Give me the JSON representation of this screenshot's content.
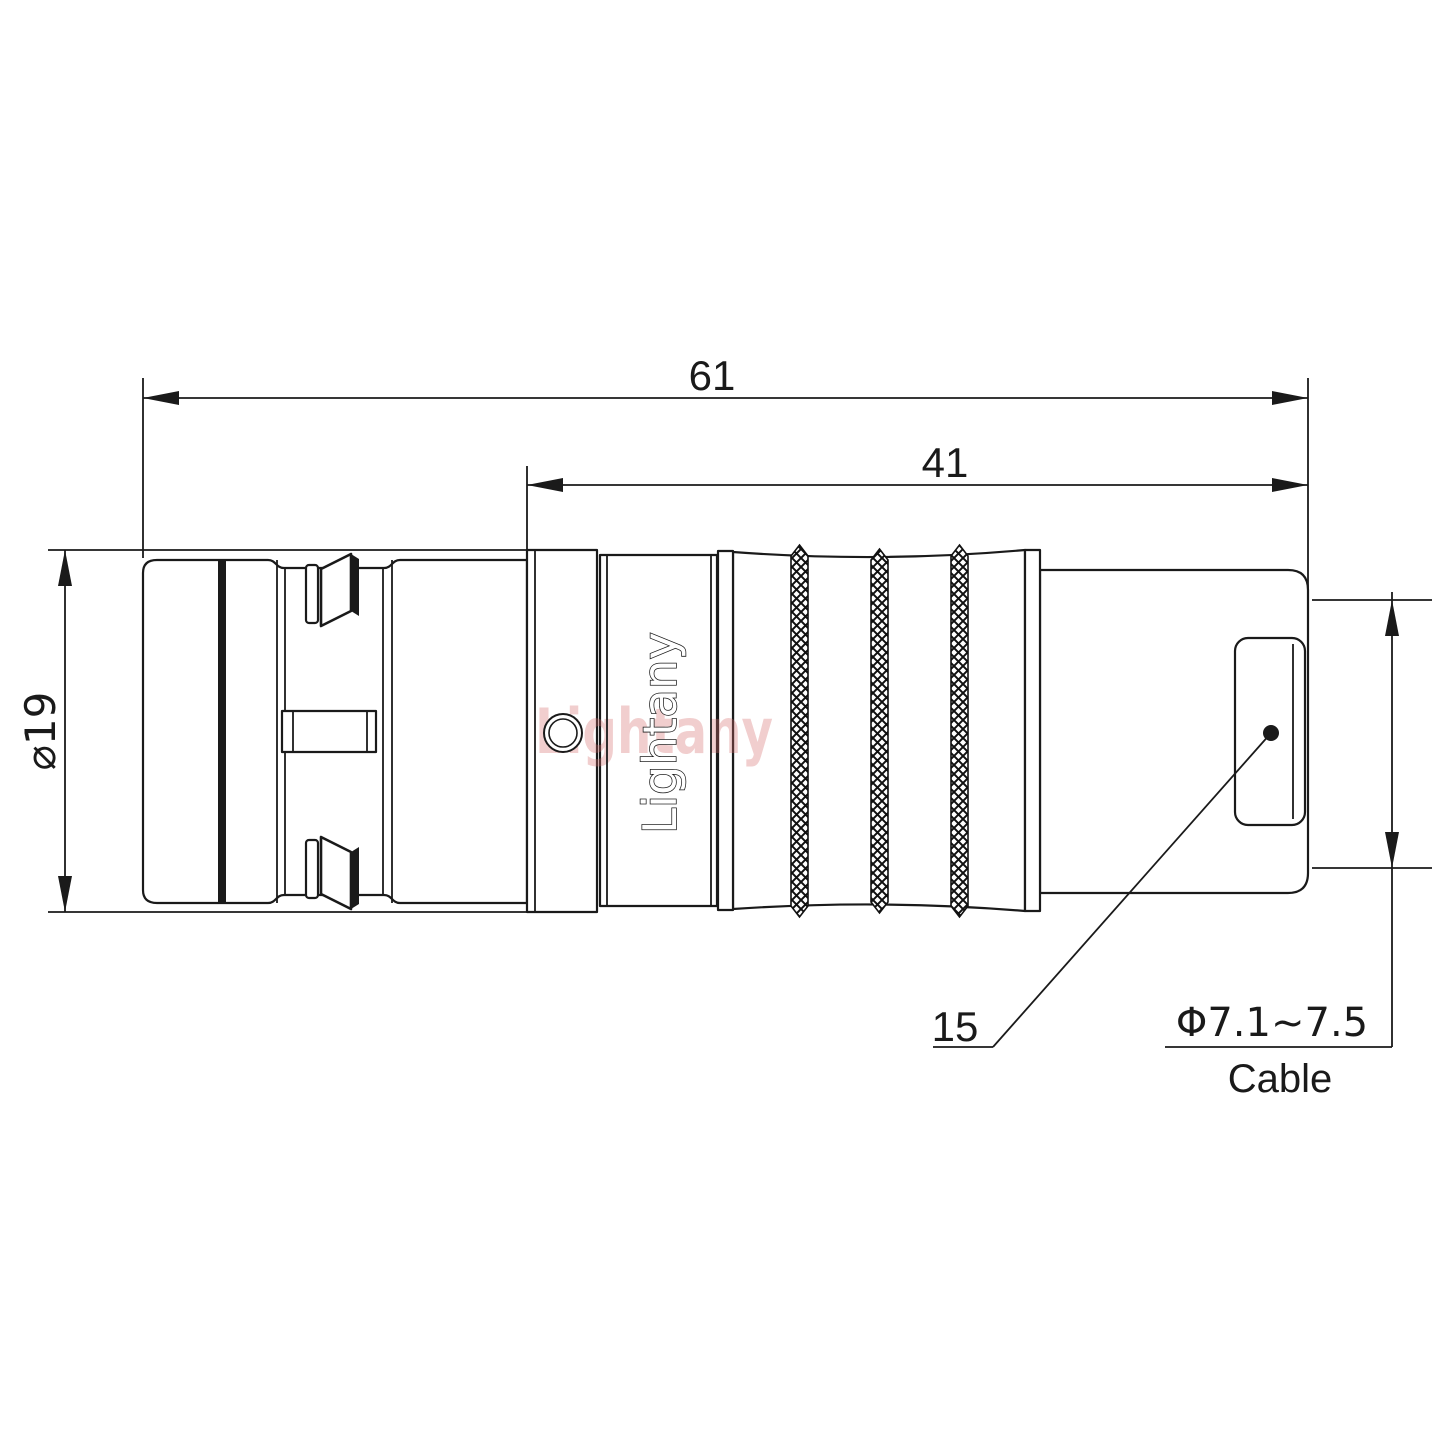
{
  "dimensions": {
    "overall_length": "61",
    "body_length": "41",
    "outer_diameter": "⌀19",
    "nut_size": "15",
    "cable_size": "Φ7.1~7.5",
    "cable_label": "Cable"
  },
  "branding": {
    "engraving": "Lightany",
    "watermark": "Lightany"
  },
  "colors": {
    "line": "#1a1a1a",
    "watermark": "#d66a6a"
  }
}
